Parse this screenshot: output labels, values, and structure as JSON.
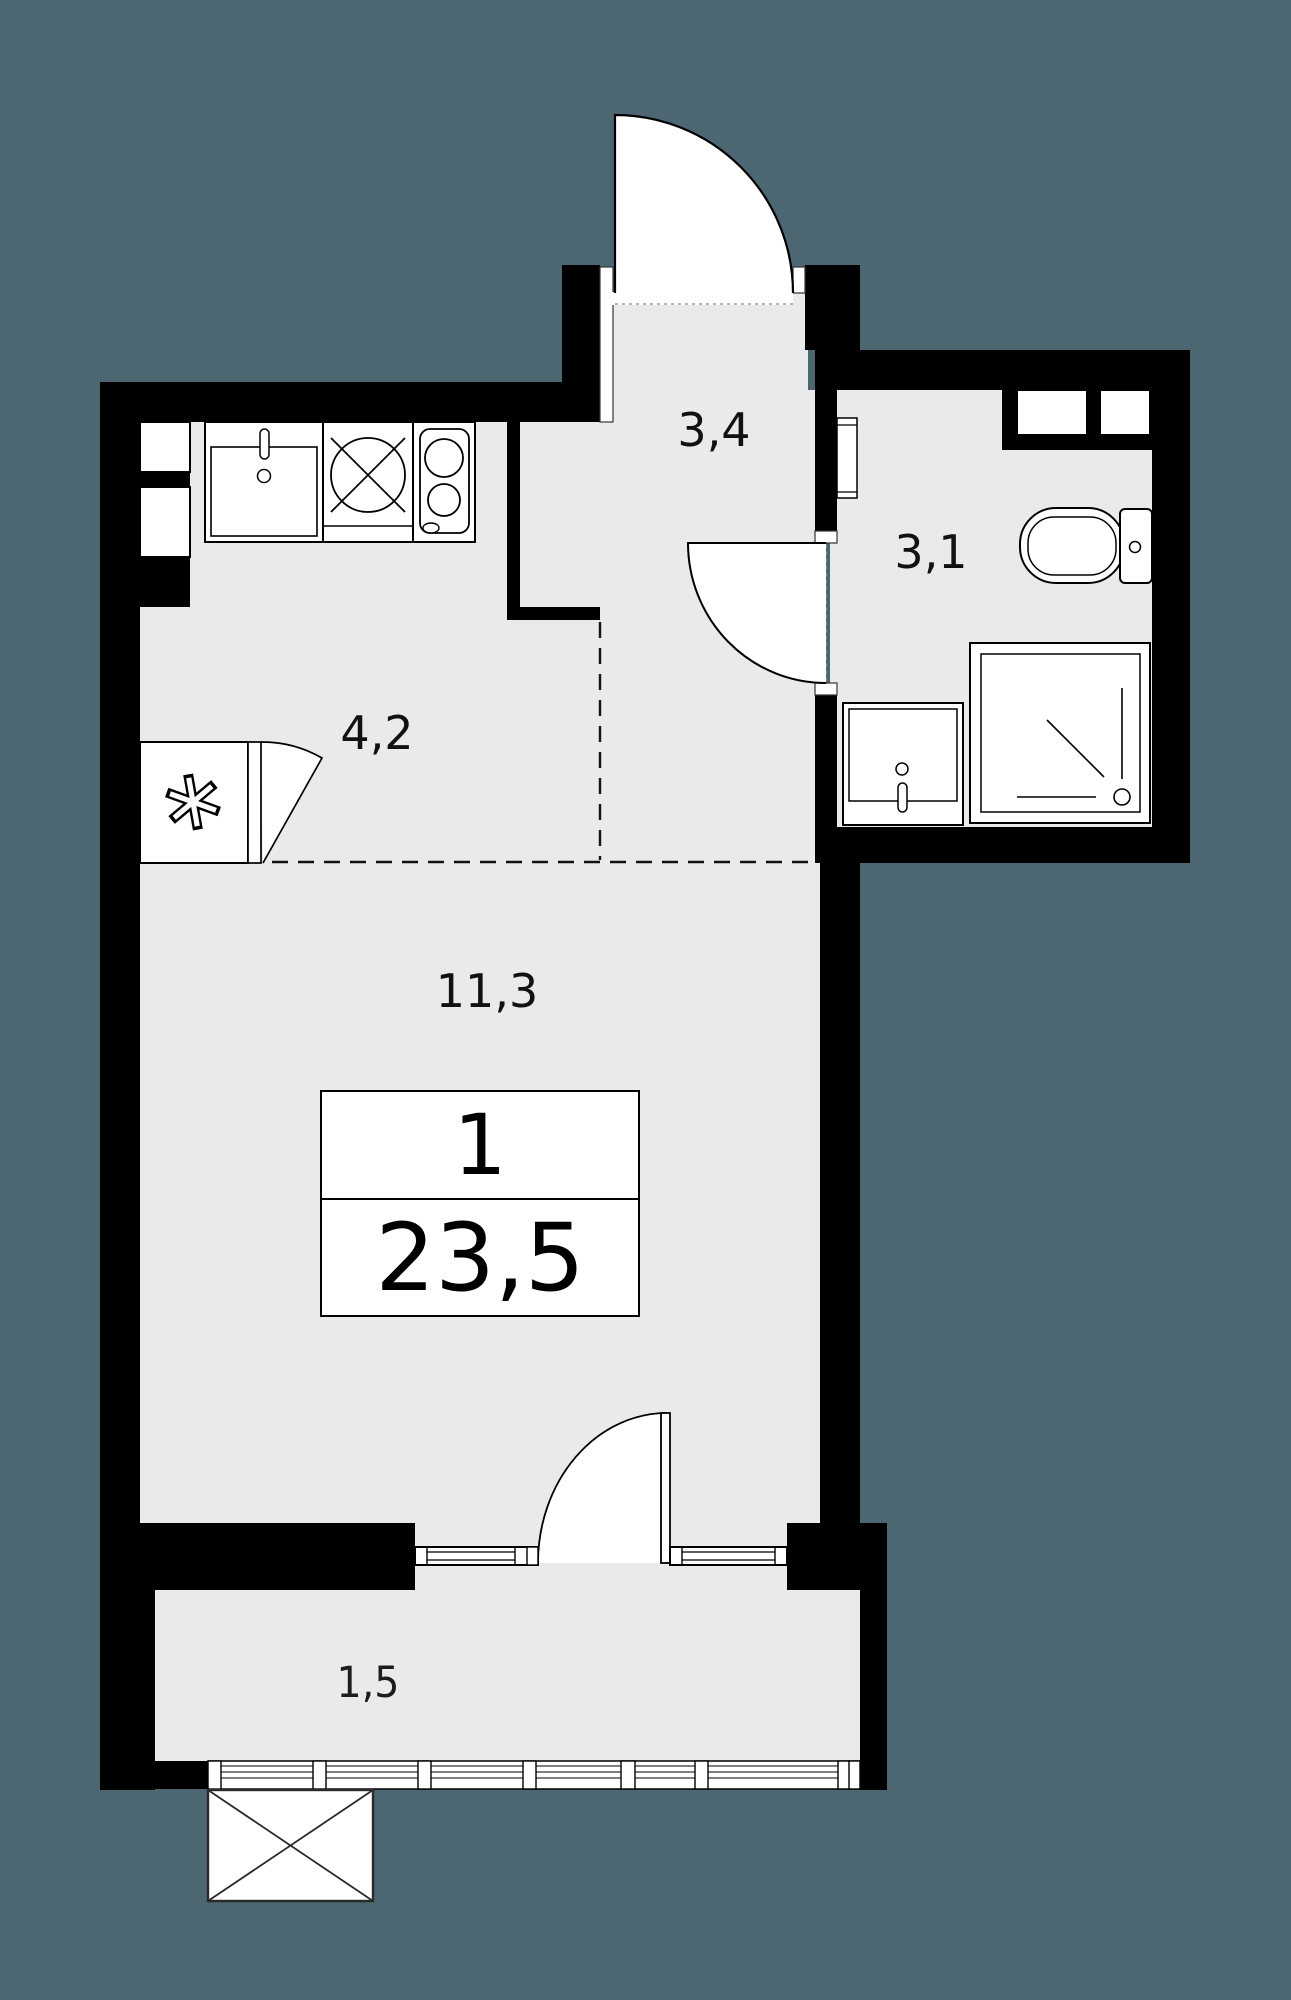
{
  "floorplan": {
    "title": "Studio apartment floor plan",
    "summary": {
      "rooms_count": "1",
      "total_area": "23,5"
    },
    "rooms": [
      {
        "id": "hallway",
        "area_label": "3,4"
      },
      {
        "id": "bathroom",
        "area_label": "3,1"
      },
      {
        "id": "kitchen",
        "area_label": "4,2"
      },
      {
        "id": "living-room",
        "area_label": "11,3"
      },
      {
        "id": "balcony",
        "area_label": "1,5"
      }
    ],
    "colors": {
      "background": "#4c6672",
      "floor": "#e8eaec",
      "wall": "#000000",
      "fixture": "#ffffff"
    },
    "fixtures": [
      "entrance-door",
      "kitchen-sink",
      "washing-machine",
      "cooktop-2-burner",
      "refrigerator",
      "ventilation-shaft",
      "bathroom-door",
      "towel-radiator",
      "toilet",
      "wash-basin",
      "shower",
      "balcony-door",
      "window",
      "balcony-glazing",
      "exterior-basket"
    ]
  }
}
